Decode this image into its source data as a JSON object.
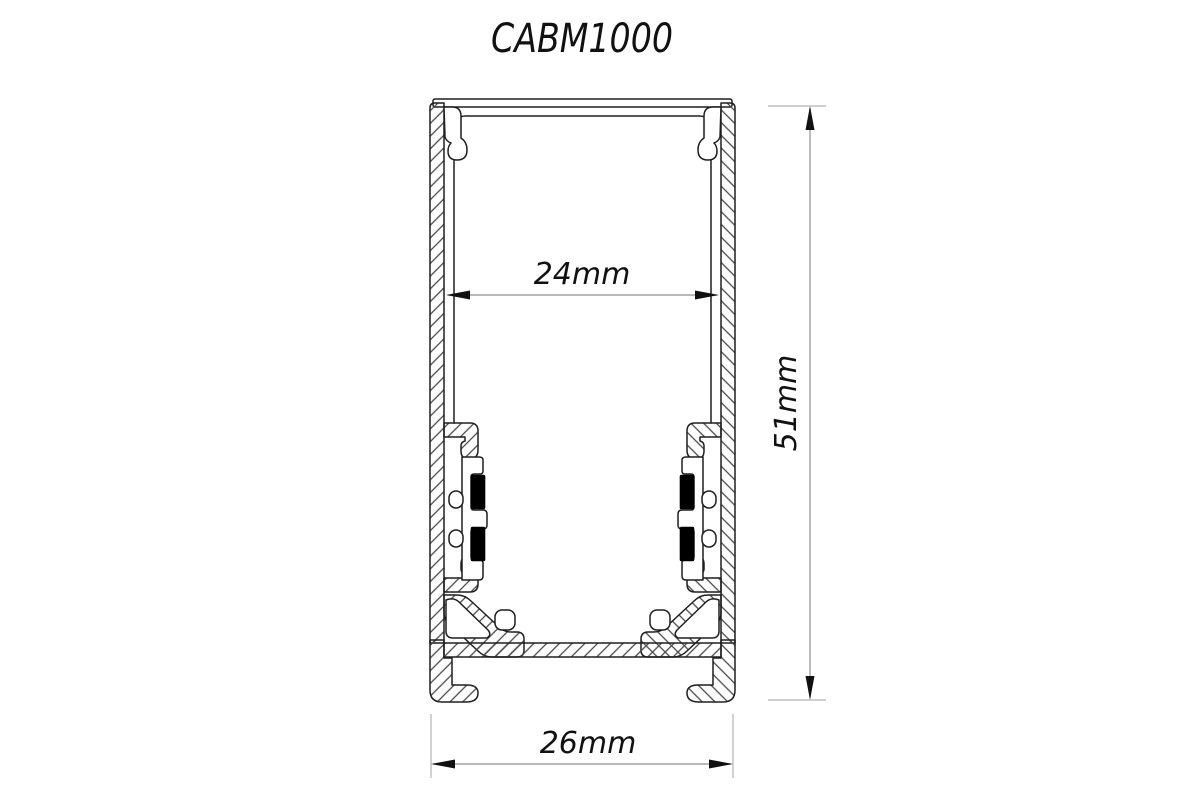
{
  "title": "CABM1000",
  "drawing": {
    "name": "aluminium-led-profile-cross-section",
    "dimensions": {
      "inner_width": {
        "label": "24mm",
        "value": 24,
        "unit": "mm"
      },
      "overall_height": {
        "label": "51mm",
        "value": 51,
        "unit": "mm"
      },
      "overall_width": {
        "label": "26mm",
        "value": 26,
        "unit": "mm"
      }
    },
    "colors": {
      "outline": "#1f1f1f",
      "hatch": "#4a4a4a",
      "dim_line": "#8f8f8f",
      "ext_line": "#b3b3b3",
      "arrow": "#111111",
      "text": "#111111",
      "gasket": "#000000",
      "background": "#ffffff"
    }
  }
}
